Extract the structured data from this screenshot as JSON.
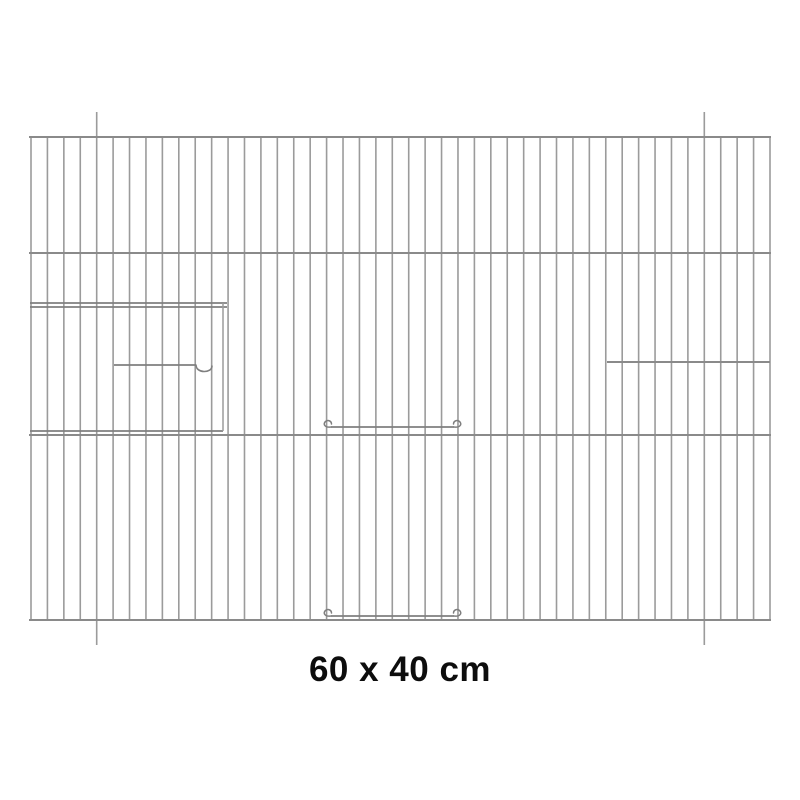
{
  "label": {
    "text": "60 x 40 cm"
  },
  "colors": {
    "background": "#ffffff",
    "wire": "#9b9b9b",
    "bar": "#8a8a8a",
    "detail": "#7f7f7f",
    "text": "#0d0d0d"
  },
  "drawing": {
    "panel": {
      "x_start": 31,
      "x_end": 770,
      "top": 137,
      "bottom": 620,
      "wire_count": 46,
      "crossbars_y": [
        137,
        253,
        435,
        620
      ],
      "protruding_wire_indices": [
        4,
        41
      ],
      "protrusion_length": 25
    },
    "left_door": {
      "x1": 30,
      "x2": 227,
      "stile_x": 223,
      "top_rail_y": 303,
      "frame_bar_y": 307,
      "bottom_rail_y": 431,
      "handle_bar_y": 365,
      "handle_bar_x1": 114,
      "handle_loop_x1": 196,
      "handle_loop_x2": 212,
      "handle_loop_depth": 8.5
    },
    "right_opening": {
      "bar_y": 362,
      "x1": 607,
      "x2": 770
    },
    "middle_door": {
      "x1": 331,
      "x2": 454,
      "top_bar_y": 427,
      "bottom_bar_y": 616
    }
  }
}
